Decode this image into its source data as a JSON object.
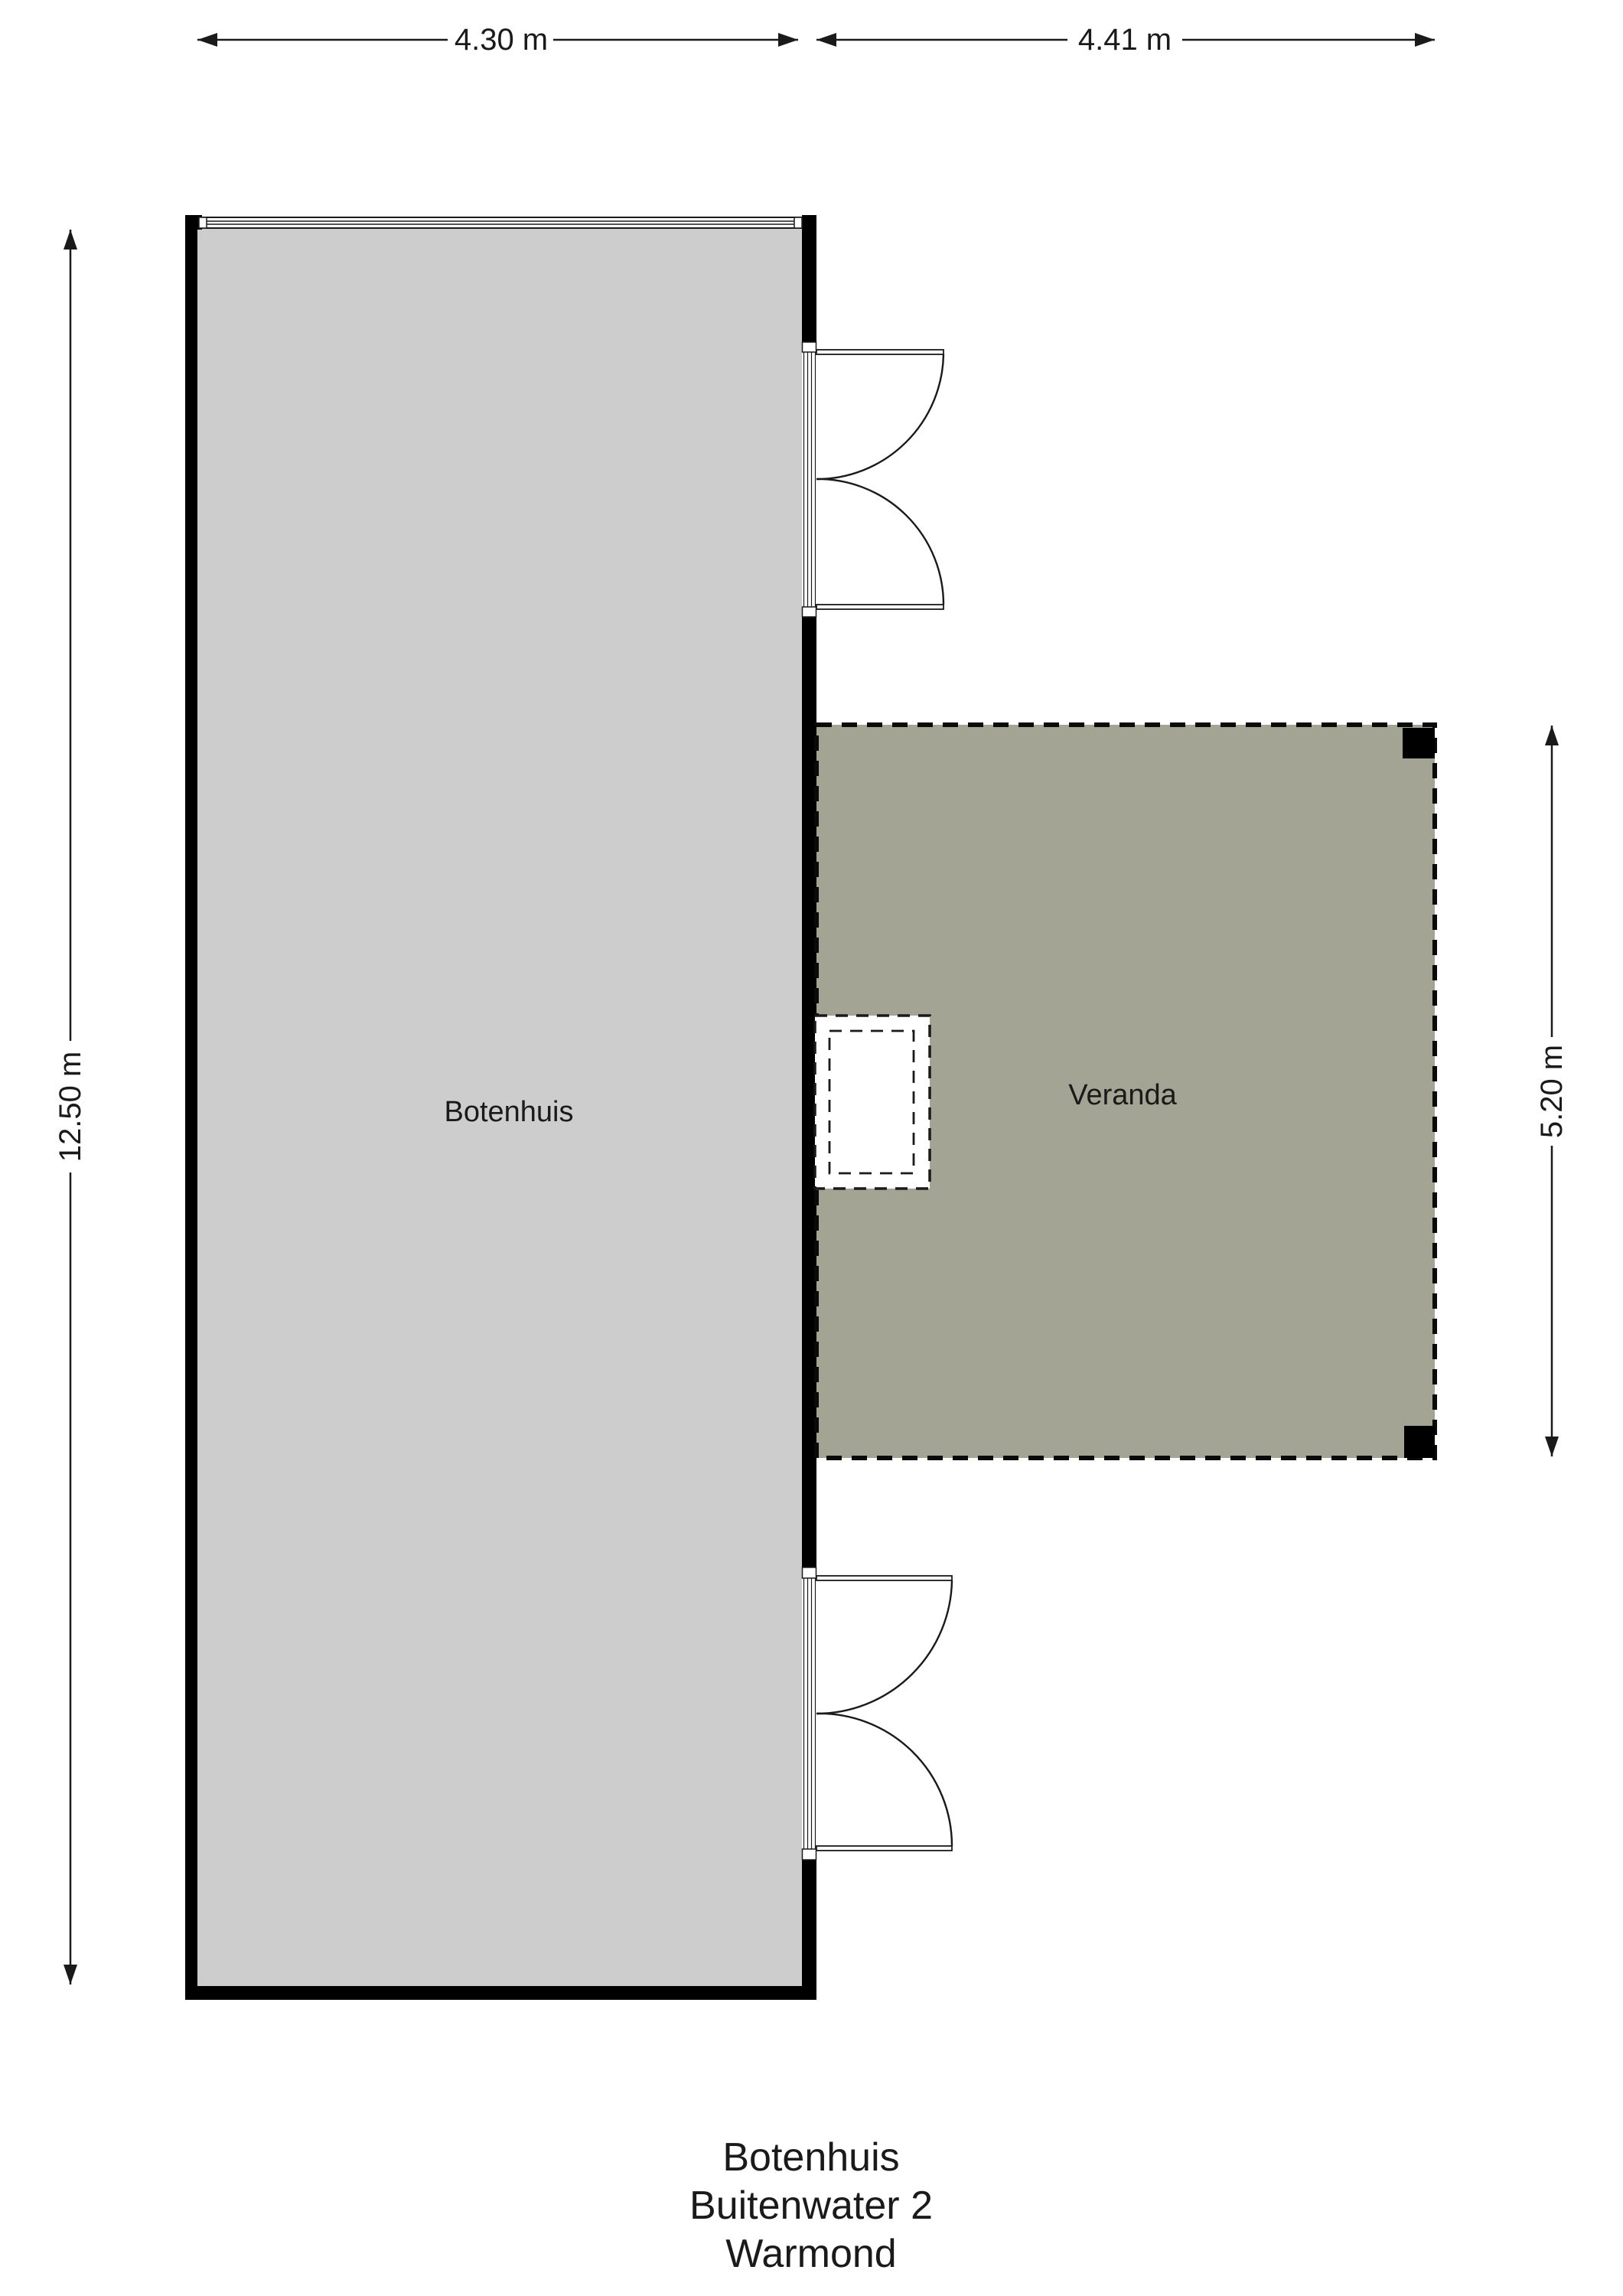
{
  "plan": {
    "dimensions": {
      "boathouse_width": "4.30 m",
      "veranda_width": "4.41 m",
      "boathouse_depth": "12.50 m",
      "veranda_depth": "5.20 m"
    },
    "rooms": {
      "boathouse_label": "Botenhuis",
      "veranda_label": "Veranda"
    },
    "footer": {
      "line1": "Botenhuis",
      "line2": "Buitenwater 2",
      "line3": "Warmond"
    },
    "colors": {
      "background": "#ffffff",
      "boathouse_fill": "#cdcdcd",
      "veranda_fill": "#a4a494",
      "wall": "#000000",
      "line": "#1a1a1a",
      "opening_fill": "#ffffff"
    }
  }
}
